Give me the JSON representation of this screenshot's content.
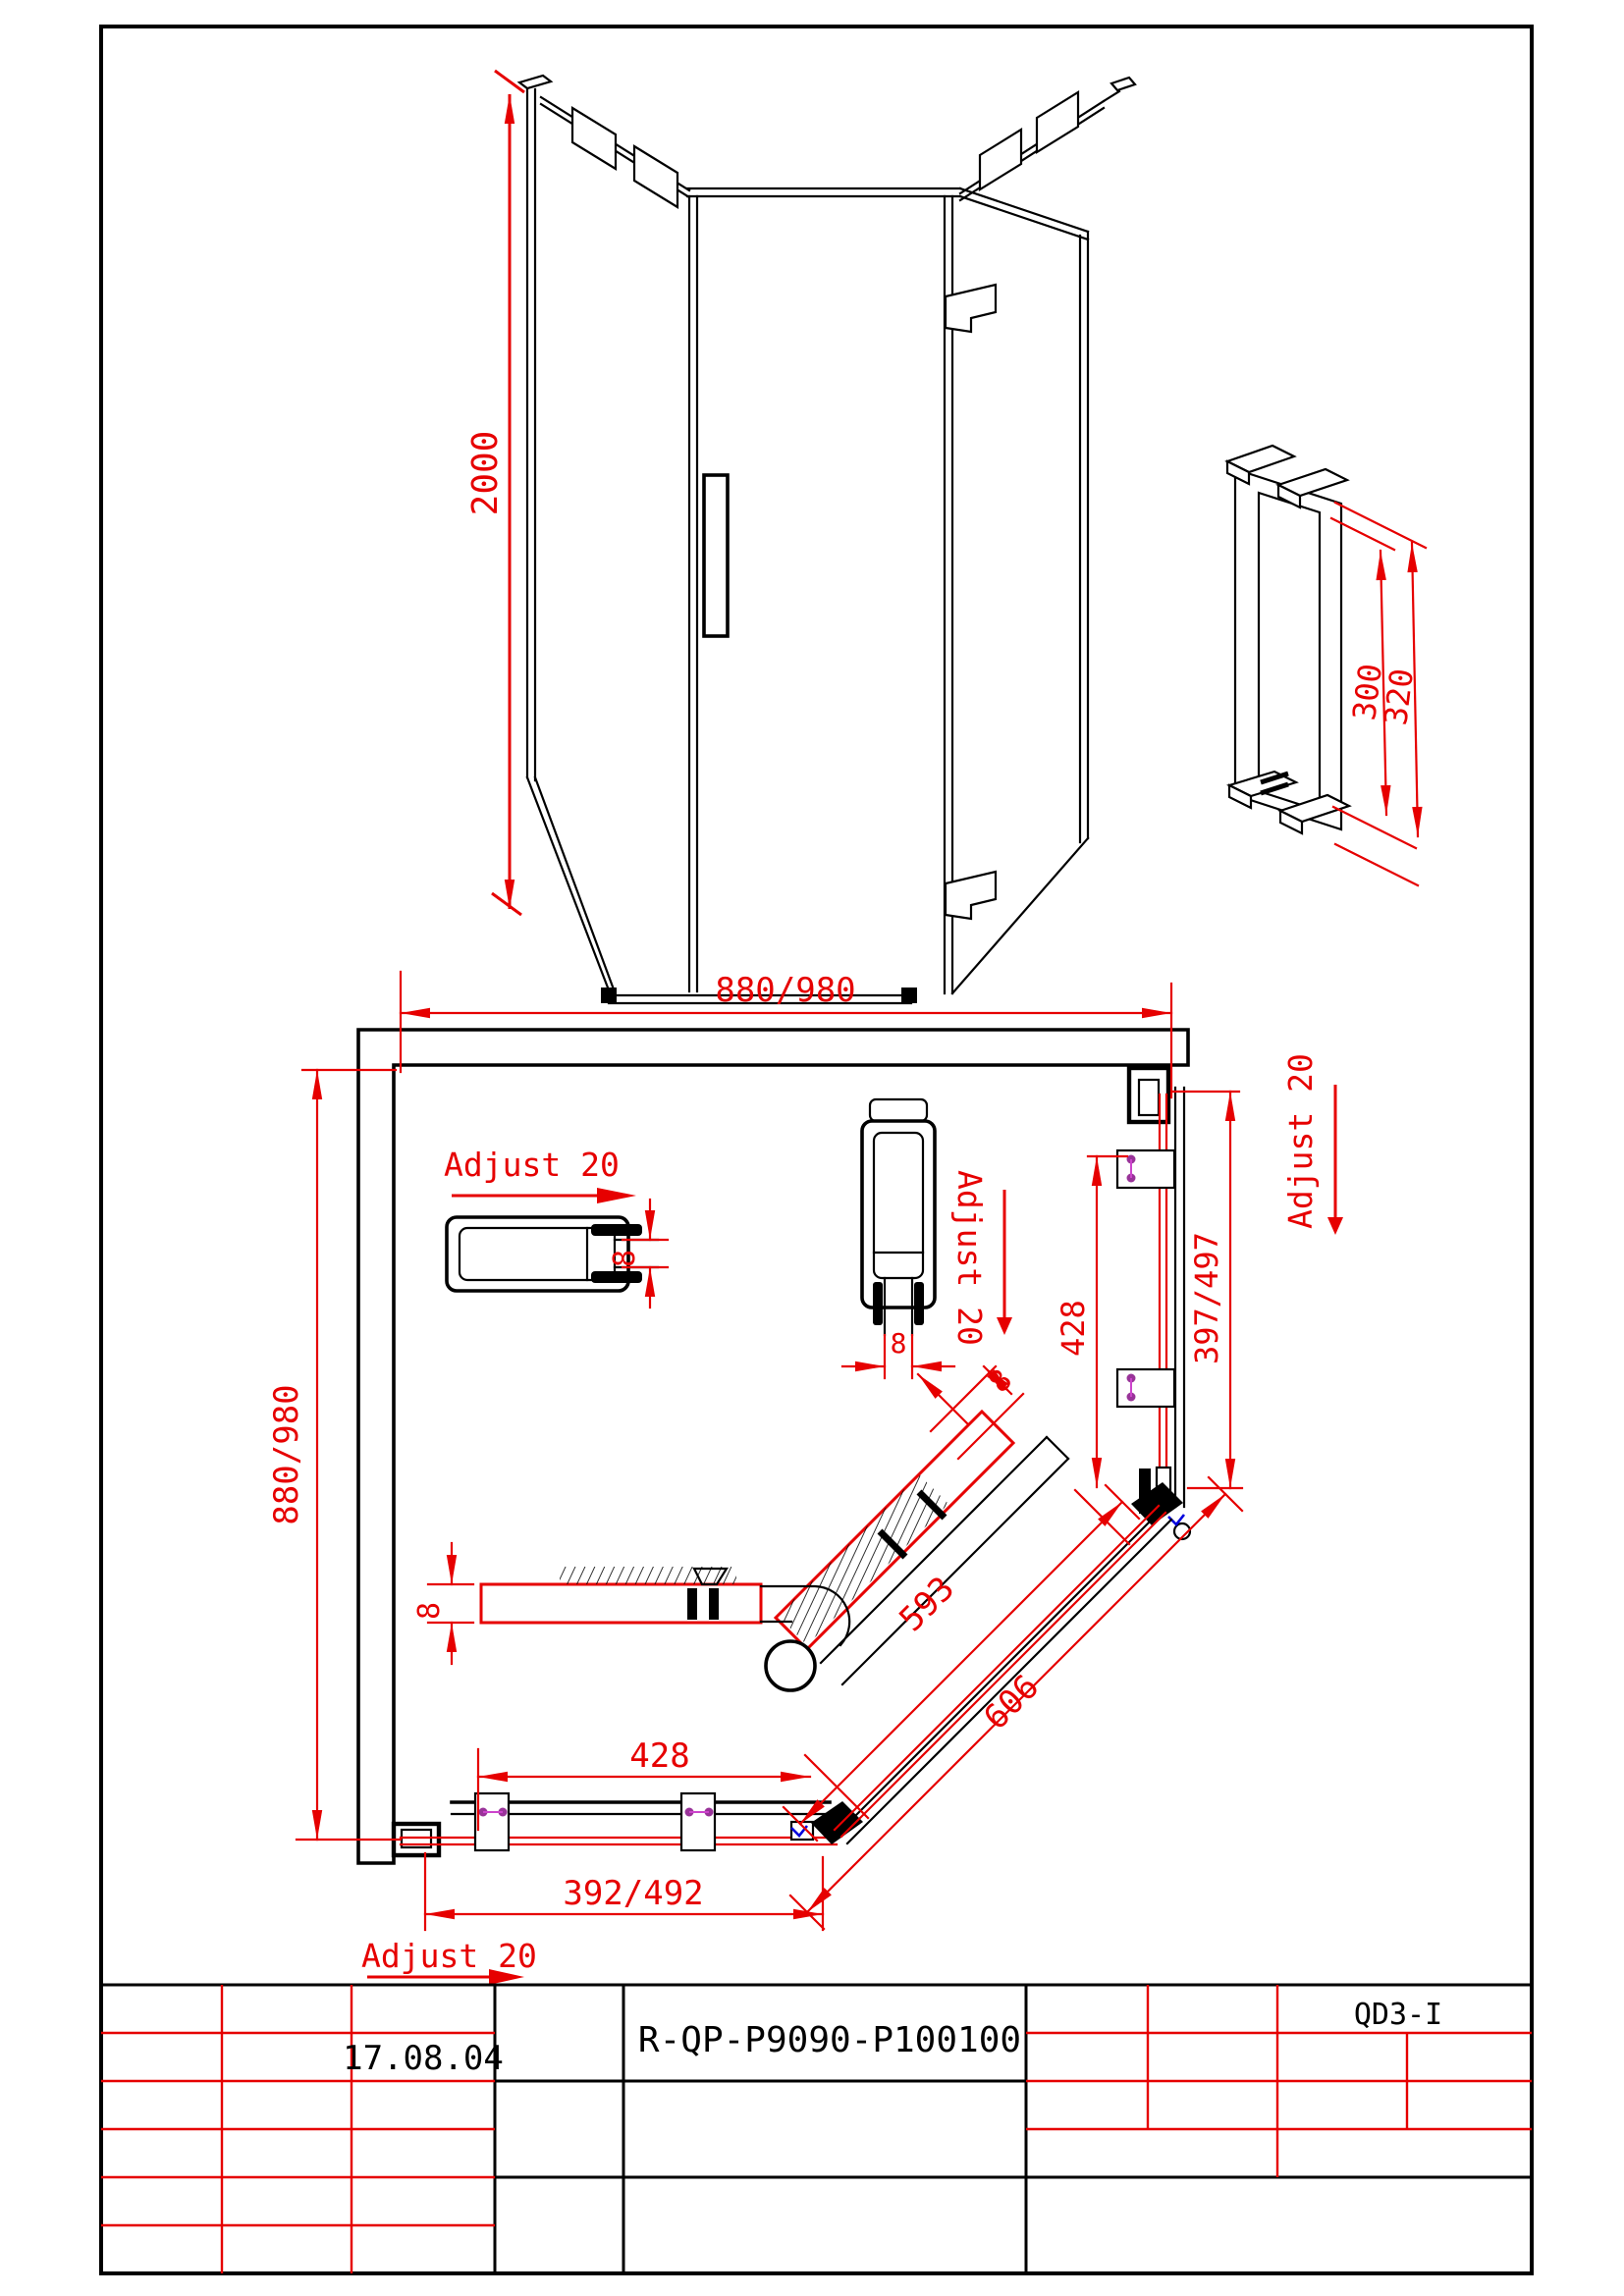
{
  "iso": {
    "height_dim": "2000"
  },
  "handle": {
    "dim_inner": "300",
    "dim_outer": "320"
  },
  "plan": {
    "dim_width": "880/980",
    "dim_depth": "880/980",
    "adjust_label": "Adjust 20",
    "dim_glass": "8",
    "dim_right_panel": "428",
    "dim_right_adjust": "397/497",
    "dim_bottom_panel": "428",
    "dim_bottom_adjust": "392/492",
    "dim_door_inner": "593",
    "dim_door_outer": "606"
  },
  "title_block": {
    "date": "17.08.04",
    "model": "R-QP-P9090-P100100",
    "code": "QD3-I"
  },
  "colors": {
    "dimension": "#e60000",
    "hatch": "#0000dd",
    "screw": "#993399",
    "line": "#000000"
  }
}
